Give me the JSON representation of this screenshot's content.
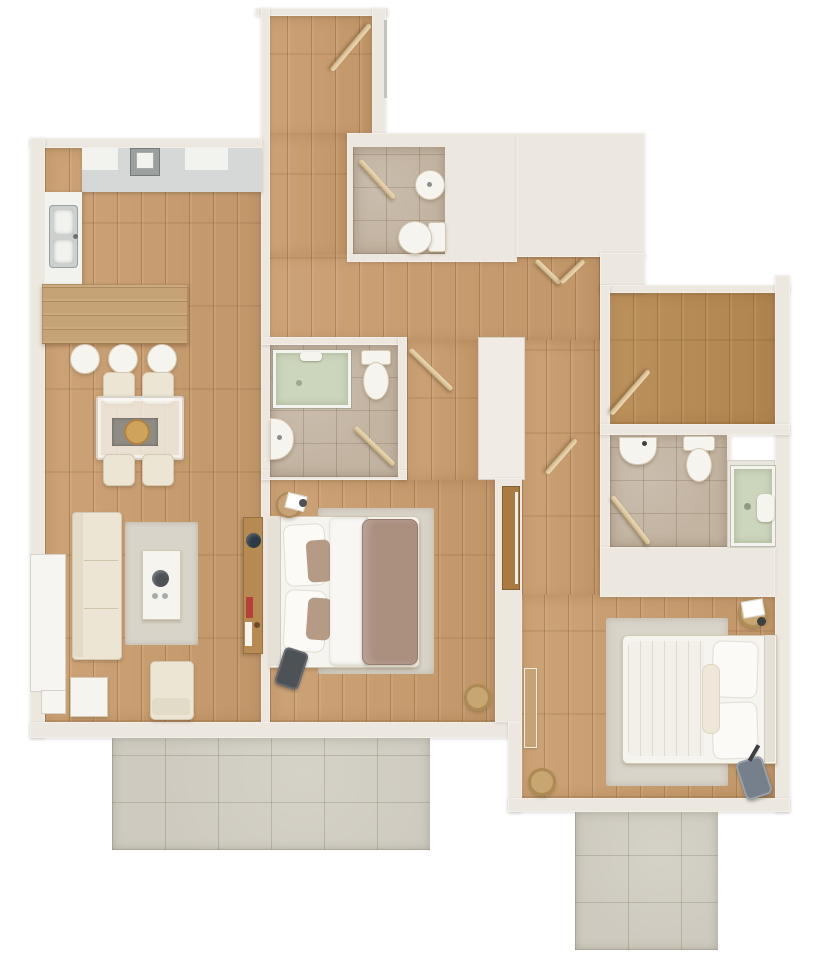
{
  "title": "apartment-3d-floor-plan",
  "palette": {
    "bg": "#ffffff",
    "wall": "#ece7df",
    "wall_edge": "#d9d2c6",
    "closet": "#f0ece5",
    "wood_light": "#c99d6e",
    "wood_mid": "#b78a52",
    "wood_dark": "#a97b42",
    "bar_wood": "#c6a376",
    "tile_bath": "#c3b4a2",
    "balcony_tile": "#cecabf",
    "glass_green": "#ccd6bd",
    "glass_frame": "#f4f3ef",
    "white_furniture": "#f6f4ef",
    "cream_furniture": "#ece5d3",
    "furniture_edge": "#d3c9b2",
    "rug": "#d9d4c9",
    "rug_dark": "#8e8c85",
    "blanket": "#ab9080",
    "pillow_accent": "#b59a85",
    "counter_gray": "#d5d8d6",
    "counter_white": "#f2f2ef",
    "stove_gray": "#9aa09e",
    "sink_gray": "#ccd1cf",
    "door_leaf": "#dcc69e",
    "dark_object": "#4d5257",
    "navy_object": "#2c3a47",
    "red_accent": "#b4423a",
    "tan_wood": "#cfa35c",
    "basket_tan": "#c8a671",
    "window_line": "#c5c3bf"
  },
  "rooms": {
    "kitchen": {
      "name": "kitchen"
    },
    "dining": {
      "name": "dining-area"
    },
    "living": {
      "name": "living-room"
    },
    "hallway": {
      "name": "hallway"
    },
    "entry": {
      "name": "entry"
    },
    "bathroom_top": {
      "name": "bathroom"
    },
    "bathroom_ensuite": {
      "name": "en-suite-bathroom"
    },
    "bathroom_right": {
      "name": "bathroom"
    },
    "bedroom_master": {
      "name": "bedroom"
    },
    "bedroom_second": {
      "name": "bedroom"
    },
    "room_right": {
      "name": "room"
    },
    "balcony_left": {
      "name": "terrace"
    },
    "balcony_right": {
      "name": "terrace"
    }
  }
}
